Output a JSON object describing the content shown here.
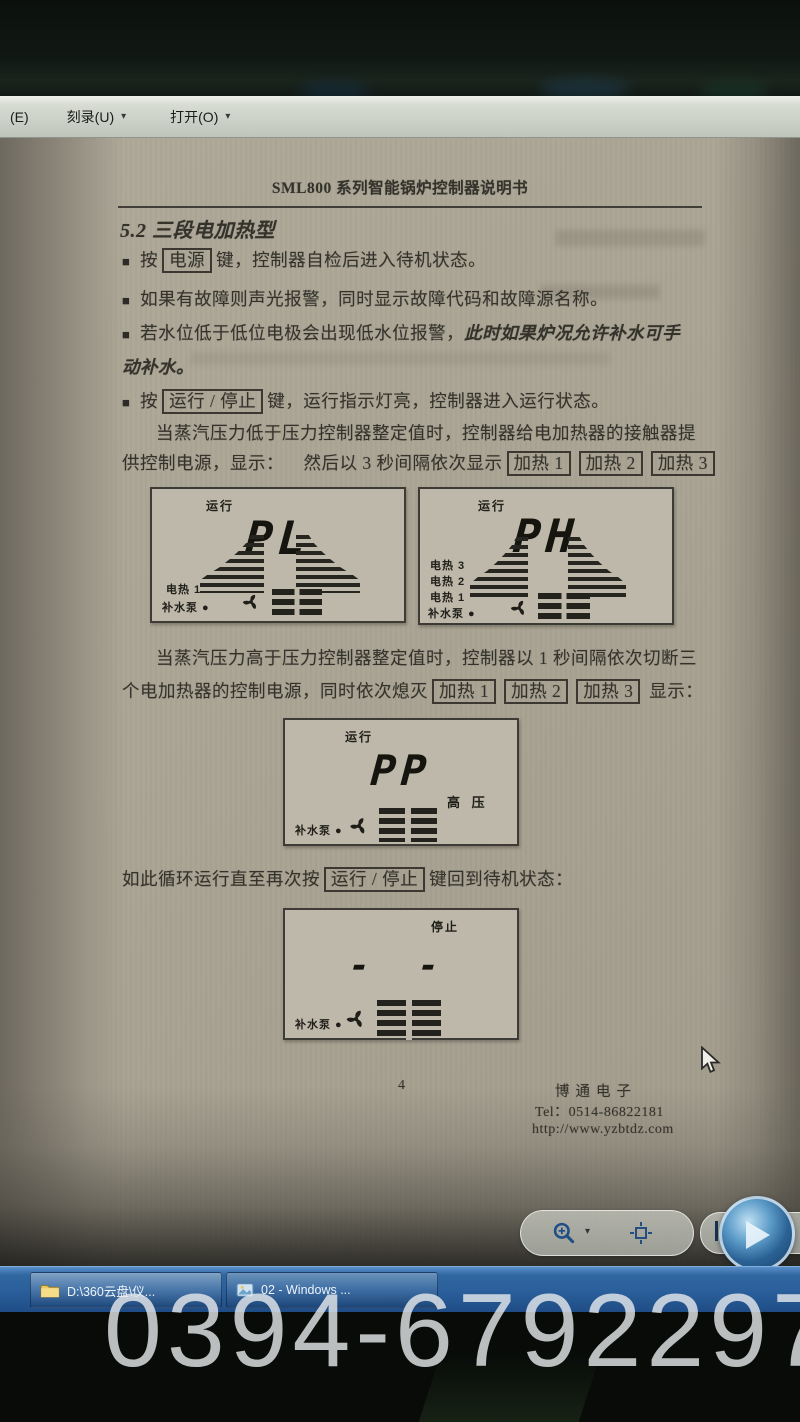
{
  "menu": {
    "caret": "▾",
    "partial_item": "(E)",
    "burn_item": "刻录(U)",
    "open_item": "打开(O)"
  },
  "doc": {
    "bullet_marker": "■",
    "title": "SML800 系列智能锅炉控制器说明书",
    "section": "5.2 三段电加热型",
    "b1": {
      "pre": "按",
      "key": "电源",
      "post": "键，控制器自检后进入待机状态。"
    },
    "b2": "如果有故障则声光报警，同时显示故障代码和故障源名称。",
    "b3": {
      "l1": "若水位低于低位电极会出现低水位报警，",
      "l1i": "此时如果炉况允许补水可手",
      "l2i": "动补水。"
    },
    "b4": {
      "pre": "按",
      "key": "运行 / 停止",
      "post": "键，运行指示灯亮，控制器进入运行状态。"
    },
    "p1": {
      "l1": "当蒸汽压力低于压力控制器整定值时，控制器给电加热器的接触器提",
      "l2pre": "供控制电源，显示：",
      "l2mid": "然后以 3 秒间隔依次显示",
      "k1": "加热 1",
      "k2": "加热 2",
      "k3": "加热 3"
    },
    "p2": {
      "l1": "当蒸汽压力高于压力控制器整定值时，控制器以 1 秒间隔依次切断三",
      "l2pre": "个电加热器的控制电源，同时依次熄灭",
      "k1": "加热 1",
      "k2": "加热 2",
      "k3": "加热 3",
      "l2post": "显示："
    },
    "p3": {
      "pre": "如此循环运行直至再次按",
      "key": "运行 / 停止",
      "post": "键回到待机状态："
    },
    "footer": {
      "page_number": "4",
      "company": "博通电子",
      "tel": "Tel：0514-86822181",
      "url": "http://www.yzbtdz.com"
    }
  },
  "lcd": {
    "pl": {
      "status": "运行",
      "value": "PL",
      "l1": "电热 1",
      "l2": "补水泵 ●"
    },
    "ph": {
      "status": "运行",
      "value": "PH",
      "l1": "电热 3",
      "l2": "电热 2",
      "l3": "电热 1",
      "l4": "补水泵 ●"
    },
    "pp": {
      "status": "运行",
      "value": "PP",
      "side": "高  压",
      "l1": "补水泵 ●"
    },
    "stop": {
      "status": "停止",
      "value": "- -",
      "l1": "补水泵 ●"
    }
  },
  "toolbar": {
    "prev_glyph": "◀",
    "zoom_icon": "magnifier",
    "fit_icon": "actual-size",
    "play_icon": "play-slideshow"
  },
  "taskbar": {
    "button1": "D:\\360云盘\\仪...",
    "button2": "02 - Windows ..."
  },
  "watermark": "0394-6792297"
}
